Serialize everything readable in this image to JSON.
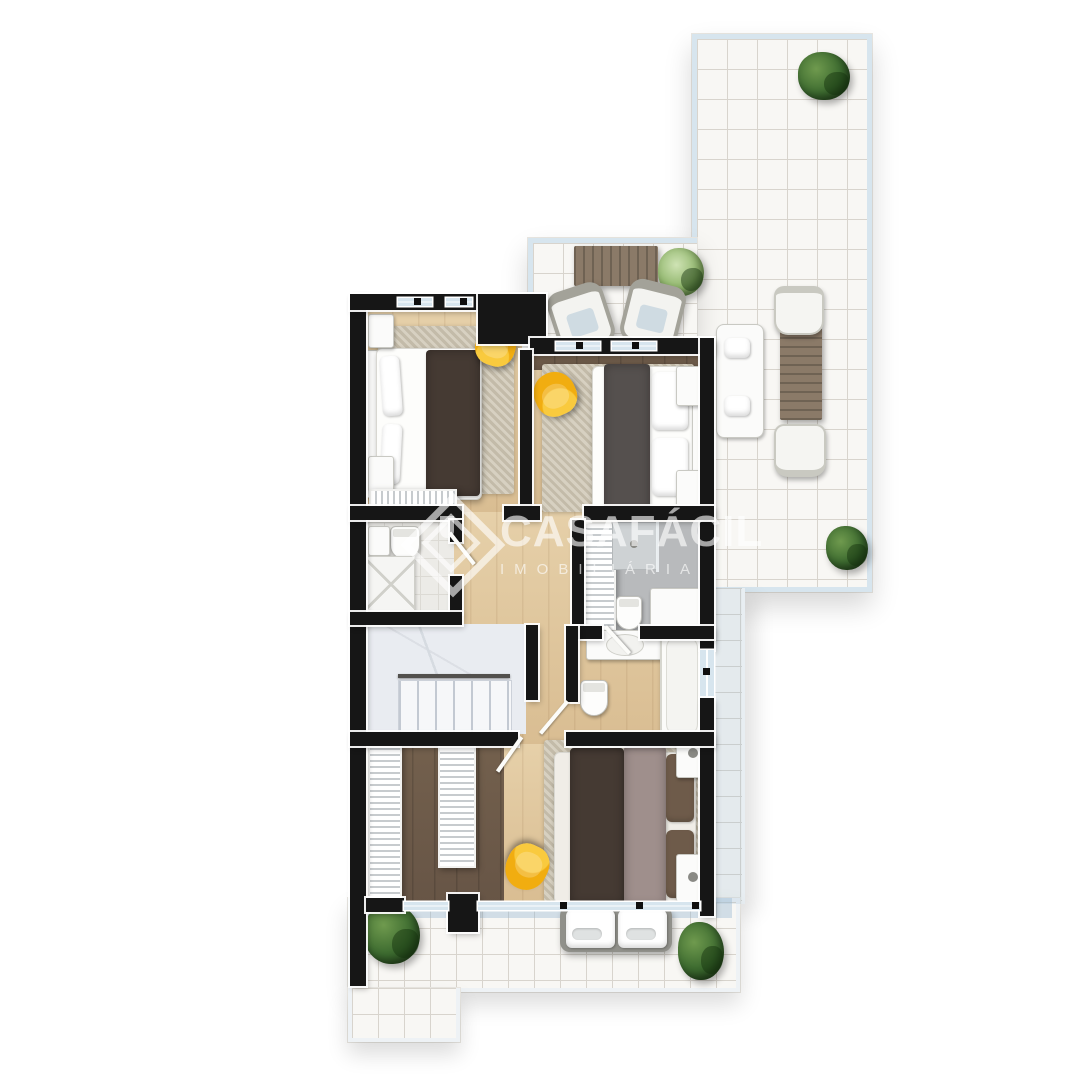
{
  "watermark": {
    "brand": "CASAFÁCIL",
    "subtitle": "IMOBILIÁRIA",
    "logo_icon": "diamond-house-logo"
  },
  "palette": {
    "wall": "#161616",
    "wood": "#e6d0a9",
    "wood_shade": "#d9bd92",
    "wood_dark": "#73604d",
    "tile": "#f8f7f4",
    "tile_line": "#d8d4cd",
    "glass": "#d7e5ee",
    "balcony_tint": "rgba(150,183,210,0.40)",
    "rug": "#cdc5b2",
    "accent_yellow": "#f1ad10",
    "plant_green": "#3c6a2f",
    "table_brown": "#8b7a68",
    "bathroom_gray": "#b8babc",
    "stairs_gray": "#e9ecf1",
    "blanket_dark": "#453a33",
    "blanket_mauve": "#9f8f8c",
    "blanket_brown": "#6e5b4a",
    "watermark_color": "rgba(255,255,255,0.62)"
  }
}
